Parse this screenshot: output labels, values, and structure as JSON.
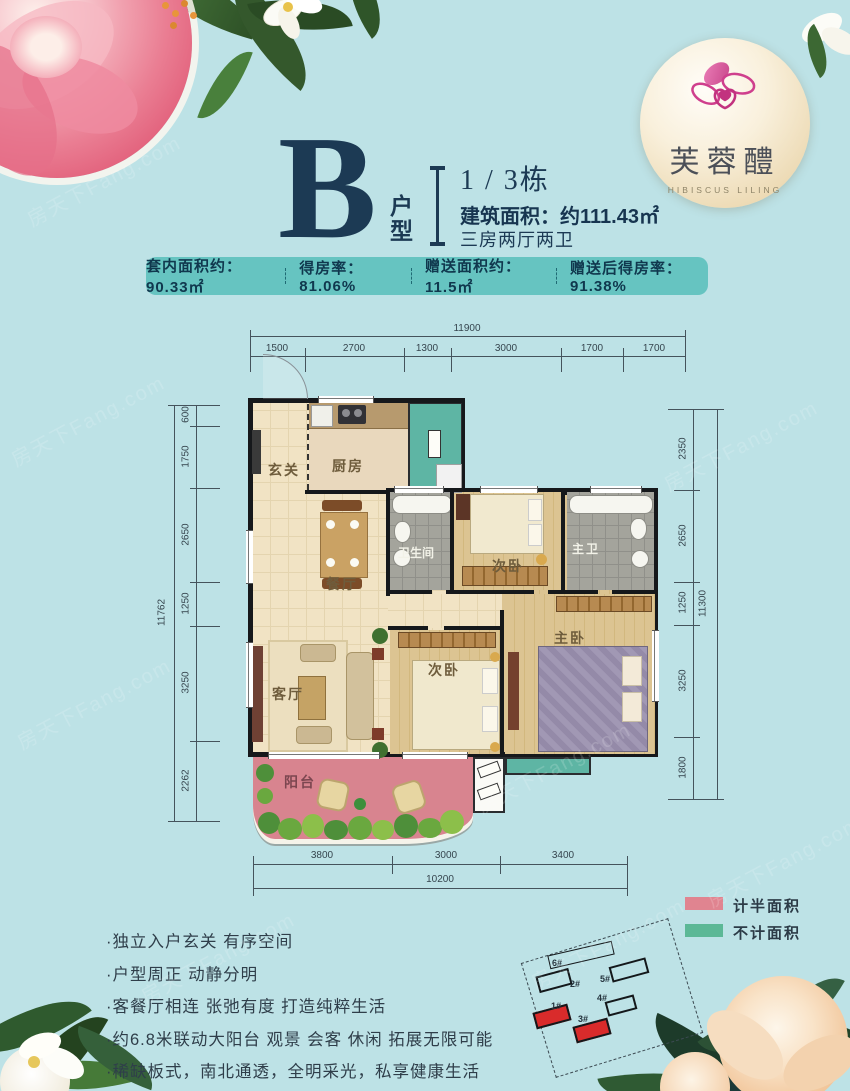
{
  "colors": {
    "background": "#bde2e6",
    "banner": "#66c4c1",
    "navy": "#1c3a54",
    "half_area_pink": "#d8848f",
    "excluded_teal": "#5eb5a4"
  },
  "logo": {
    "name": "芙蓉醴",
    "subtitle": "HIBISCUS LILING"
  },
  "header": {
    "unit_letter": "B",
    "unit_label_1": "户",
    "unit_label_2": "型",
    "building": "1 / 3栋",
    "area_line": "建筑面积：约111.43㎡",
    "layout_line": "三房两厅两卫"
  },
  "banner": {
    "items": [
      "套内面积约：90.33㎡",
      "得房率：81.06%",
      "赠送面积约：11.5㎡",
      "赠送后得房率：91.38%"
    ]
  },
  "plan": {
    "dims_top": {
      "total": "11900",
      "segments": [
        "1500",
        "2700",
        "1300",
        "3000",
        "1700",
        "1700"
      ]
    },
    "dims_left": {
      "total": "11762",
      "segments": [
        "600",
        "1750",
        "2650",
        "1250",
        "3250",
        "2262"
      ]
    },
    "dims_right": {
      "total": "11300",
      "segments": [
        "2350",
        "2650",
        "1250",
        "3250",
        "1800"
      ]
    },
    "dims_bottom": {
      "total": "10200",
      "segments": [
        "3800",
        "3000",
        "3400"
      ]
    },
    "rooms": {
      "entry": "玄关",
      "kitchen": "厨房",
      "dining": "餐厅",
      "living": "客厅",
      "bath": "卫生间",
      "bedroom_a": "次卧",
      "master_bath": "主卫",
      "bedroom_b": "次卧",
      "master_bedroom": "主卧",
      "balcony": "阳台"
    }
  },
  "legend": {
    "items": [
      {
        "label": "计半面积",
        "color": "#e08490"
      },
      {
        "label": "不计面积",
        "color": "#5cb896"
      }
    ]
  },
  "features": [
    "·独立入户玄关 有序空间",
    "·户型周正 动静分明",
    "·客餐厅相连 张弛有度 打造纯粹生活",
    "·约6.8米联动大阳台 观景 会客 休闲 拓展无限可能",
    "·稀缺板式，南北通透，全明采光，私享健康生活"
  ],
  "siteplan": {
    "buildings": [
      "6#",
      "2#",
      "5#",
      "4#",
      "1#",
      "3#"
    ],
    "highlighted": [
      "1#",
      "3#"
    ]
  },
  "watermark": "房天下Fang.com"
}
